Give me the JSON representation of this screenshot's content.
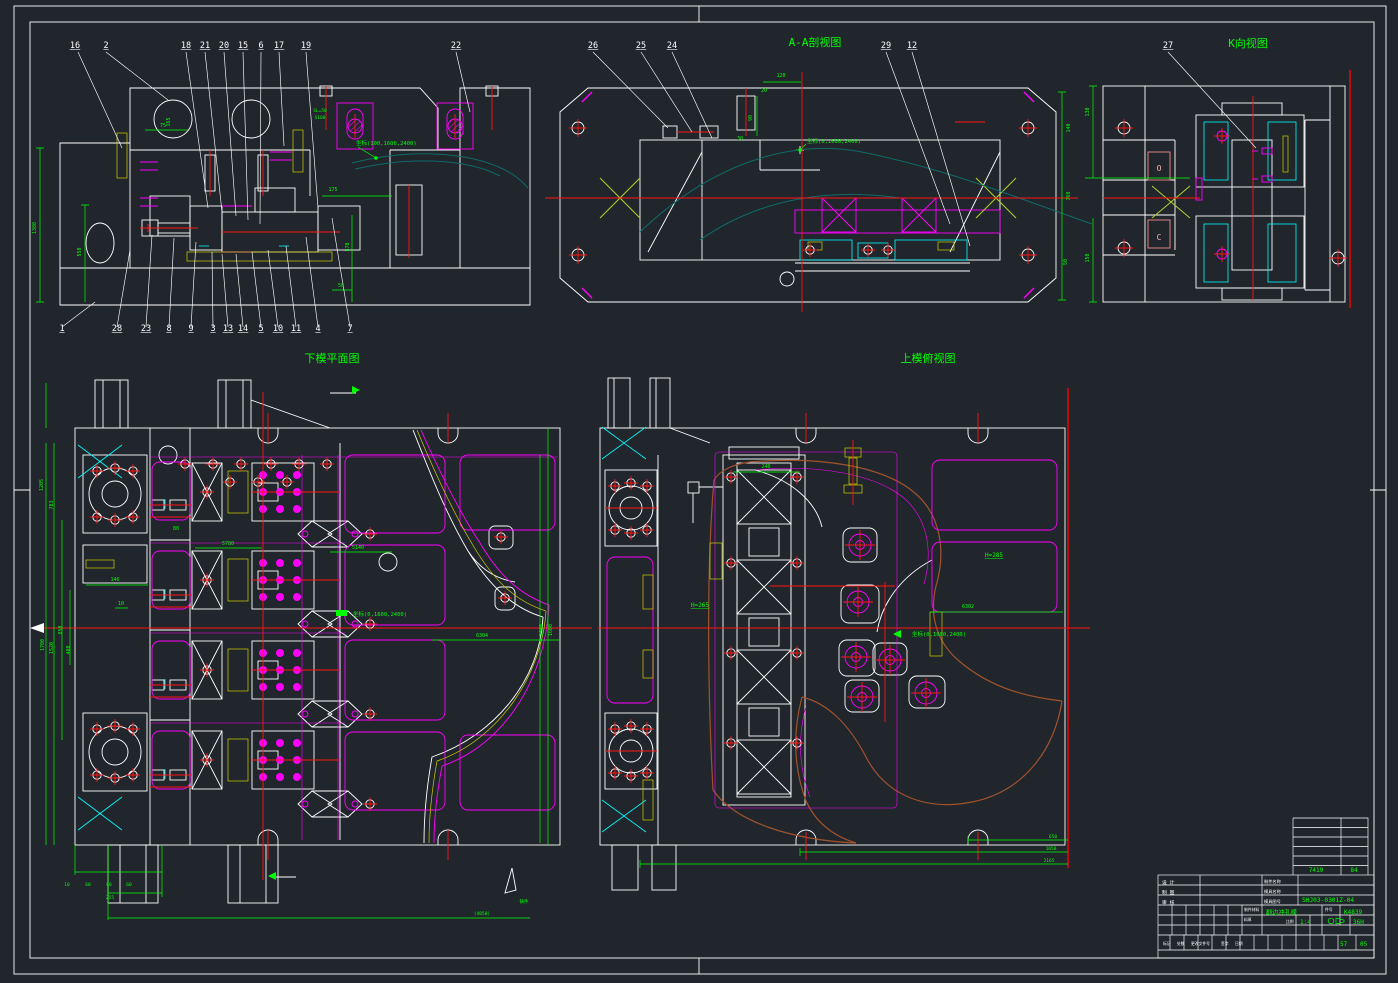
{
  "colors": {
    "background": "#21262c",
    "line_white": "#ffffff",
    "annotation": "#00ff00",
    "detail_magenta": "#ff00ff",
    "centerline_red": "#ff1414",
    "hatch_yellow": "#e8e800",
    "hatch_cyan": "#00e5e5",
    "profile_teal": "#0f6a6a",
    "part_brown": "#a0522d"
  },
  "title_block_summary": {
    "drawing_number": "SHJ03-0301Z-04",
    "die_name": "翻边冲孔模",
    "code": "K4839",
    "scale": "1:4",
    "sheet_no": "05"
  },
  "texts": {
    "sheet": [
      {
        "t": "A-A剖视图",
        "x": 815,
        "y": 46,
        "fs": 11,
        "n": "view-title-aa-section"
      },
      {
        "t": "K向视图",
        "x": 1248,
        "y": 47,
        "fs": 11,
        "n": "view-title-k-view"
      },
      {
        "t": "下模平面图",
        "x": 332,
        "y": 362,
        "fs": 11,
        "n": "view-title-lower-die-plan"
      },
      {
        "t": "上模俯视图",
        "x": 928,
        "y": 362,
        "fs": 11,
        "n": "view-title-upper-die-plan"
      }
    ],
    "v1": [
      {
        "t": "16",
        "x": 75,
        "y": 48,
        "c": "#ffffff",
        "fs": 8.5,
        "ul": true,
        "n": "balloon-16"
      },
      {
        "t": "2",
        "x": 106,
        "y": 48,
        "c": "#ffffff",
        "fs": 8.5,
        "ul": true,
        "n": "balloon-2"
      },
      {
        "t": "18",
        "x": 186,
        "y": 48,
        "c": "#ffffff",
        "fs": 8.5,
        "ul": true,
        "n": "balloon-18"
      },
      {
        "t": "21",
        "x": 205,
        "y": 48,
        "c": "#ffffff",
        "fs": 8.5,
        "ul": true,
        "n": "balloon-21"
      },
      {
        "t": "20",
        "x": 224,
        "y": 48,
        "c": "#ffffff",
        "fs": 8.5,
        "ul": true,
        "n": "balloon-20"
      },
      {
        "t": "15",
        "x": 243,
        "y": 48,
        "c": "#ffffff",
        "fs": 8.5,
        "ul": true,
        "n": "balloon-15"
      },
      {
        "t": "6",
        "x": 261,
        "y": 48,
        "c": "#ffffff",
        "fs": 8.5,
        "ul": true,
        "n": "balloon-6"
      },
      {
        "t": "17",
        "x": 279,
        "y": 48,
        "c": "#ffffff",
        "fs": 8.5,
        "ul": true,
        "n": "balloon-17"
      },
      {
        "t": "19",
        "x": 306,
        "y": 48,
        "c": "#ffffff",
        "fs": 8.5,
        "ul": true,
        "n": "balloon-19"
      },
      {
        "t": "22",
        "x": 456,
        "y": 48,
        "c": "#ffffff",
        "fs": 8.5,
        "ul": true,
        "n": "balloon-22"
      },
      {
        "t": "1",
        "x": 62,
        "y": 331,
        "c": "#ffffff",
        "fs": 8.5,
        "ul": true,
        "n": "balloon-1"
      },
      {
        "t": "28",
        "x": 117,
        "y": 331,
        "c": "#ffffff",
        "fs": 8.5,
        "ul": true,
        "n": "balloon-28"
      },
      {
        "t": "23",
        "x": 146,
        "y": 331,
        "c": "#ffffff",
        "fs": 8.5,
        "ul": true,
        "n": "balloon-23"
      },
      {
        "t": "8",
        "x": 169,
        "y": 331,
        "c": "#ffffff",
        "fs": 8.5,
        "ul": true,
        "n": "balloon-8"
      },
      {
        "t": "9",
        "x": 191,
        "y": 331,
        "c": "#ffffff",
        "fs": 8.5,
        "ul": true,
        "n": "balloon-9"
      },
      {
        "t": "3",
        "x": 213,
        "y": 331,
        "c": "#ffffff",
        "fs": 8.5,
        "ul": true,
        "n": "balloon-3"
      },
      {
        "t": "13",
        "x": 228,
        "y": 331,
        "c": "#ffffff",
        "fs": 8.5,
        "ul": true,
        "n": "balloon-13"
      },
      {
        "t": "14",
        "x": 243,
        "y": 331,
        "c": "#ffffff",
        "fs": 8.5,
        "ul": true,
        "n": "balloon-14"
      },
      {
        "t": "5",
        "x": 261,
        "y": 331,
        "c": "#ffffff",
        "fs": 8.5,
        "ul": true,
        "n": "balloon-5"
      },
      {
        "t": "10",
        "x": 278,
        "y": 331,
        "c": "#ffffff",
        "fs": 8.5,
        "ul": true,
        "n": "balloon-10"
      },
      {
        "t": "11",
        "x": 296,
        "y": 331,
        "c": "#ffffff",
        "fs": 8.5,
        "ul": true,
        "n": "balloon-11"
      },
      {
        "t": "4",
        "x": 318,
        "y": 331,
        "c": "#ffffff",
        "fs": 8.5,
        "ul": true,
        "n": "balloon-4"
      },
      {
        "t": "7",
        "x": 350,
        "y": 331,
        "c": "#ffffff",
        "fs": 8.5,
        "ul": true,
        "n": "balloon-7"
      },
      {
        "t": "75",
        "x": 163,
        "y": 127,
        "fs": 5,
        "n": "dim"
      },
      {
        "t": "165",
        "x": 170,
        "y": 122,
        "fs": 5,
        "rot": -90,
        "n": "dim"
      },
      {
        "t": "1380",
        "x": 36,
        "y": 228,
        "fs": 5,
        "rot": -90,
        "n": "dim"
      },
      {
        "t": "550",
        "x": 81,
        "y": 252,
        "fs": 5,
        "rot": -90,
        "n": "dim"
      },
      {
        "t": "175",
        "x": 333,
        "y": 191,
        "fs": 5,
        "n": "dim"
      },
      {
        "t": "570",
        "x": 349,
        "y": 247,
        "fs": 5,
        "rot": -90,
        "n": "dim"
      },
      {
        "t": "50",
        "x": 341,
        "y": 287,
        "fs": 5,
        "n": "dim"
      },
      {
        "t": "SL=50",
        "x": 320,
        "y": 112,
        "fs": 4.5,
        "n": "dim"
      },
      {
        "t": "S100",
        "x": 320,
        "y": 119,
        "fs": 4.5,
        "n": "dim"
      },
      {
        "t": "坐标(100,1600,2400)",
        "x": 356,
        "y": 145,
        "fs": 5.5,
        "a": "start",
        "n": "coordinate-note"
      }
    ],
    "v2": [
      {
        "t": "26",
        "x": 593,
        "y": 48,
        "c": "#ffffff",
        "fs": 8.5,
        "ul": true,
        "n": "balloon-26"
      },
      {
        "t": "25",
        "x": 641,
        "y": 48,
        "c": "#ffffff",
        "fs": 8.5,
        "ul": true,
        "n": "balloon-25"
      },
      {
        "t": "24",
        "x": 672,
        "y": 48,
        "c": "#ffffff",
        "fs": 8.5,
        "ul": true,
        "n": "balloon-24"
      },
      {
        "t": "29",
        "x": 886,
        "y": 48,
        "c": "#ffffff",
        "fs": 8.5,
        "ul": true,
        "n": "balloon-29"
      },
      {
        "t": "12",
        "x": 912,
        "y": 48,
        "c": "#ffffff",
        "fs": 8.5,
        "ul": true,
        "n": "balloon-12"
      },
      {
        "t": "120",
        "x": 781,
        "y": 77,
        "fs": 5,
        "n": "dim"
      },
      {
        "t": "20",
        "x": 764,
        "y": 92,
        "fs": 5,
        "n": "dim"
      },
      {
        "t": "90",
        "x": 752,
        "y": 118,
        "fs": 5,
        "rot": -90,
        "n": "dim"
      },
      {
        "t": "30",
        "x": 740,
        "y": 140,
        "fs": 5,
        "n": "dim"
      },
      {
        "t": "坐标(0,1600,2400)",
        "x": 807,
        "y": 143,
        "fs": 5.5,
        "a": "start",
        "n": "coordinate-note"
      },
      {
        "t": "140",
        "x": 1070,
        "y": 128,
        "fs": 5,
        "rot": -90,
        "n": "dim"
      },
      {
        "t": "760",
        "x": 1070,
        "y": 196,
        "fs": 5,
        "rot": -90,
        "n": "dim"
      },
      {
        "t": "50",
        "x": 1067,
        "y": 262,
        "fs": 5,
        "rot": -90,
        "n": "dim"
      }
    ],
    "v3": [
      {
        "t": "27",
        "x": 1168,
        "y": 48,
        "c": "#ffffff",
        "fs": 8.5,
        "ul": true,
        "n": "balloon-27"
      },
      {
        "t": "130",
        "x": 1089,
        "y": 112,
        "fs": 5,
        "rot": -90,
        "n": "dim"
      },
      {
        "t": "150",
        "x": 1089,
        "y": 258,
        "fs": 5,
        "rot": -90,
        "n": "dim"
      },
      {
        "t": "O",
        "x": 1159,
        "y": 171,
        "c": "#ffb3b3",
        "fs": 8,
        "n": "section-letter-o"
      },
      {
        "t": "C",
        "x": 1159,
        "y": 240,
        "c": "#ffb3b3",
        "fs": 8,
        "n": "section-letter-c"
      }
    ],
    "v4": [
      {
        "t": "146",
        "x": 115,
        "y": 581,
        "fs": 5,
        "n": "dim"
      },
      {
        "t": "10",
        "x": 121,
        "y": 605,
        "fs": 5,
        "n": "dim"
      },
      {
        "t": "80",
        "x": 176,
        "y": 530,
        "fs": 5,
        "n": "dim"
      },
      {
        "t": "1205",
        "x": 43,
        "y": 485,
        "fs": 5,
        "rot": -90,
        "n": "dim"
      },
      {
        "t": "783",
        "x": 53,
        "y": 505,
        "fs": 5,
        "rot": -90,
        "n": "dim"
      },
      {
        "t": "1700",
        "x": 44,
        "y": 645,
        "fs": 5,
        "rot": -90,
        "n": "dim"
      },
      {
        "t": "1520",
        "x": 53,
        "y": 648,
        "fs": 5,
        "rot": -90,
        "n": "dim"
      },
      {
        "t": "850",
        "x": 62,
        "y": 630,
        "fs": 5,
        "rot": -90,
        "n": "dim"
      },
      {
        "t": "400",
        "x": 70,
        "y": 650,
        "fs": 5,
        "rot": -90,
        "n": "dim"
      },
      {
        "t": "5780",
        "x": 228,
        "y": 545,
        "fs": 5,
        "n": "dim"
      },
      {
        "t": "5140",
        "x": 358,
        "y": 549,
        "fs": 5,
        "n": "dim"
      },
      {
        "t": "6304",
        "x": 482,
        "y": 637,
        "fs": 5,
        "n": "dim"
      },
      {
        "t": "1300",
        "x": 543,
        "y": 630,
        "fs": 5,
        "rot": -90,
        "n": "dim"
      },
      {
        "t": "1600",
        "x": 552,
        "y": 630,
        "fs": 5,
        "rot": -90,
        "n": "dim"
      },
      {
        "t": "坐标(0,1600,2400)",
        "x": 353,
        "y": 616,
        "fs": 5.5,
        "a": "start",
        "n": "coordinate-note"
      },
      {
        "t": "10",
        "x": 67,
        "y": 886,
        "fs": 4.5,
        "n": "dim"
      },
      {
        "t": "60",
        "x": 88,
        "y": 886,
        "fs": 4.5,
        "n": "dim"
      },
      {
        "t": "80",
        "x": 109,
        "y": 886,
        "fs": 4.5,
        "n": "dim"
      },
      {
        "t": "60",
        "x": 129,
        "y": 886,
        "fs": 4.5,
        "n": "dim"
      },
      {
        "t": "255",
        "x": 110,
        "y": 899,
        "fs": 4.5,
        "n": "dim"
      },
      {
        "t": "(4050)",
        "x": 482,
        "y": 915,
        "fs": 4.5,
        "n": "dim"
      },
      {
        "t": "铸件",
        "x": 524,
        "y": 903,
        "fs": 4.5,
        "n": "note"
      }
    ],
    "v5": [
      {
        "t": "240",
        "x": 766,
        "y": 468,
        "fs": 5,
        "n": "dim"
      },
      {
        "t": "H=265",
        "x": 700,
        "y": 607,
        "fs": 6,
        "ul": true,
        "n": "height-note"
      },
      {
        "t": "H=285",
        "x": 994,
        "y": 557,
        "fs": 6,
        "ul": true,
        "n": "height-note"
      },
      {
        "t": "6302",
        "x": 968,
        "y": 608,
        "fs": 5,
        "n": "dim"
      },
      {
        "t": "坐标(0,1600,2400)",
        "x": 912,
        "y": 636,
        "fs": 5.5,
        "a": "start",
        "n": "coordinate-note"
      },
      {
        "t": "650",
        "x": 1053,
        "y": 838,
        "fs": 4.5,
        "n": "dim"
      },
      {
        "t": "1050",
        "x": 1051,
        "y": 850,
        "fs": 4.5,
        "n": "dim"
      },
      {
        "t": "2165",
        "x": 1049,
        "y": 862,
        "fs": 4.5,
        "n": "dim"
      }
    ],
    "tb": [
      {
        "t": "7419",
        "x": 1316,
        "y": 872,
        "fs": 6,
        "n": "part-code"
      },
      {
        "t": "84",
        "x": 1354,
        "y": 872,
        "fs": 6,
        "n": "part-code"
      },
      {
        "t": "设 计",
        "x": 1162,
        "y": 884,
        "a": "start",
        "c": "#ffffff",
        "fs": 4.8,
        "n": "tb-label-design"
      },
      {
        "t": "制 图",
        "x": 1162,
        "y": 894,
        "a": "start",
        "c": "#ffffff",
        "fs": 4.8,
        "n": "tb-label-draft"
      },
      {
        "t": "审 核",
        "x": 1162,
        "y": 904,
        "a": "start",
        "c": "#ffffff",
        "fs": 4.8,
        "n": "tb-label-check"
      },
      {
        "t": "制件名称",
        "x": 1264,
        "y": 883,
        "a": "start",
        "c": "#ffffff",
        "fs": 4.2,
        "n": "tb-label-part-name"
      },
      {
        "t": "模具名称",
        "x": 1264,
        "y": 893,
        "a": "start",
        "c": "#ffffff",
        "fs": 4.2,
        "n": "tb-label-die-name"
      },
      {
        "t": "模具图号",
        "x": 1264,
        "y": 903,
        "a": "start",
        "c": "#ffffff",
        "fs": 4.2,
        "n": "tb-label-die-number"
      },
      {
        "t": "SHJ03-0301Z-04",
        "x": 1302,
        "y": 902,
        "a": "start",
        "fs": 6.2,
        "n": "tb-drawing-number"
      },
      {
        "t": "翻边冲孔模",
        "x": 1266,
        "y": 914.5,
        "a": "start",
        "fs": 6.2,
        "n": "tb-die-name-value"
      },
      {
        "t": "制件材料",
        "x": 1244,
        "y": 911,
        "a": "start",
        "c": "#ffffff",
        "fs": 3.8,
        "n": "tb-label-material"
      },
      {
        "t": "料厚",
        "x": 1244,
        "y": 921,
        "a": "start",
        "c": "#ffffff",
        "fs": 3.8,
        "n": "tb-label-thickness"
      },
      {
        "t": "件号",
        "x": 1325,
        "y": 911,
        "a": "start",
        "c": "#ffffff",
        "fs": 3.8,
        "n": "tb-label-item-no"
      },
      {
        "t": "K4839",
        "x": 1344,
        "y": 914,
        "a": "start",
        "fs": 6,
        "n": "tb-code-value"
      },
      {
        "t": "比例",
        "x": 1286,
        "y": 923,
        "a": "start",
        "c": "#ffffff",
        "fs": 3.8,
        "n": "tb-label-scale"
      },
      {
        "t": "1:4",
        "x": 1300,
        "y": 924,
        "a": "start",
        "fs": 6,
        "n": "tb-scale-value"
      },
      {
        "t": "36H",
        "x": 1353,
        "y": 924,
        "a": "start",
        "fs": 6,
        "n": "tb-material-value"
      },
      {
        "t": "标记",
        "x": 1163,
        "y": 945,
        "a": "start",
        "c": "#ffffff",
        "fs": 3.8,
        "n": "tb-label-mark"
      },
      {
        "t": "处数",
        "x": 1177,
        "y": 945,
        "a": "start",
        "c": "#ffffff",
        "fs": 3.8,
        "n": "tb-label-count"
      },
      {
        "t": "更改文件号",
        "x": 1191,
        "y": 945,
        "a": "start",
        "c": "#ffffff",
        "fs": 3.8,
        "n": "tb-label-change-doc"
      },
      {
        "t": "签字",
        "x": 1221,
        "y": 945,
        "a": "start",
        "c": "#ffffff",
        "fs": 3.8,
        "n": "tb-label-sign"
      },
      {
        "t": "日期",
        "x": 1235,
        "y": 945,
        "a": "start",
        "c": "#ffffff",
        "fs": 3.8,
        "n": "tb-label-date"
      },
      {
        "t": "57",
        "x": 1340,
        "y": 946,
        "a": "start",
        "fs": 6,
        "n": "tb-sheet-count"
      },
      {
        "t": "05",
        "x": 1360,
        "y": 946,
        "a": "start",
        "fs": 6,
        "n": "tb-sheet-number"
      }
    ]
  }
}
